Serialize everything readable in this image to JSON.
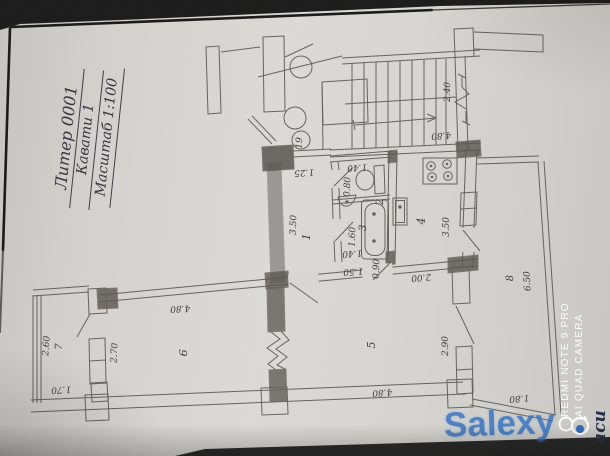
{
  "title_block": {
    "line1": "Литер 0001",
    "line2": "Кавати 1",
    "line3": "Масштаб 1:100"
  },
  "plan": {
    "entrance_circle_label": "19",
    "labels": [
      {
        "t": "1",
        "x": 310,
        "y": 237,
        "r": -88,
        "s": 11
      },
      {
        "t": "2",
        "x": 383,
        "y": 202,
        "r": -88,
        "s": 10
      },
      {
        "t": "3",
        "x": 366,
        "y": 228,
        "r": -88,
        "s": 10
      },
      {
        "t": "4",
        "x": 425,
        "y": 221,
        "r": -90,
        "s": 11
      },
      {
        "t": "5",
        "x": 375,
        "y": 345,
        "r": -90,
        "s": 11
      },
      {
        "t": "6",
        "x": 187,
        "y": 353,
        "r": -87,
        "s": 11
      },
      {
        "t": "7",
        "x": 62,
        "y": 347,
        "r": -86,
        "s": 10
      },
      {
        "t": "8",
        "x": 513,
        "y": 278,
        "r": -93,
        "s": 10
      },
      {
        "t": "19",
        "x": 302,
        "y": 143,
        "r": -88,
        "s": 9
      },
      {
        "t": "3.50",
        "x": 296,
        "y": 225,
        "r": -88,
        "s": 9
      },
      {
        "t": "1.25",
        "x": 304,
        "y": 170,
        "r": 176,
        "s": 9
      },
      {
        "t": "1.40",
        "x": 357,
        "y": 165,
        "r": 176,
        "s": 9
      },
      {
        "t": "0.80",
        "x": 350,
        "y": 187,
        "r": -88,
        "s": 9
      },
      {
        "t": "1.60",
        "x": 355,
        "y": 237,
        "r": -88,
        "s": 9
      },
      {
        "t": "1.40",
        "x": 352,
        "y": 251,
        "r": 176,
        "s": 9
      },
      {
        "t": "1.50",
        "x": 353,
        "y": 269,
        "r": 176,
        "s": 9
      },
      {
        "t": "0.90",
        "x": 379,
        "y": 269,
        "r": -88,
        "s": 9
      },
      {
        "t": "2.00",
        "x": 421,
        "y": 275,
        "r": 176,
        "s": 9
      },
      {
        "t": "3.50",
        "x": 449,
        "y": 227,
        "r": -90,
        "s": 9
      },
      {
        "t": "2.40",
        "x": 450,
        "y": 92,
        "r": -89,
        "s": 9
      },
      {
        "t": "4.80",
        "x": 441,
        "y": 133,
        "r": 176,
        "s": 9
      },
      {
        "t": "4.80",
        "x": 180,
        "y": 306,
        "r": 177,
        "s": 9
      },
      {
        "t": "2.70",
        "x": 117,
        "y": 353,
        "r": -87,
        "s": 9
      },
      {
        "t": "2.60",
        "x": 49,
        "y": 346,
        "r": -86,
        "s": 9
      },
      {
        "t": "1.70",
        "x": 61,
        "y": 387,
        "r": 177,
        "s": 9
      },
      {
        "t": "4.80",
        "x": 382,
        "y": 390,
        "r": 176,
        "s": 9
      },
      {
        "t": "2.90",
        "x": 448,
        "y": 346,
        "r": -91,
        "s": 9
      },
      {
        "t": "6.50",
        "x": 530,
        "y": 281,
        "r": -93,
        "s": 9
      },
      {
        "t": "1.80",
        "x": 519,
        "y": 396,
        "r": 176,
        "s": 9
      }
    ]
  },
  "watermarks": {
    "brand": "Salexy",
    "camera_line1": "REDMI NOTE 9 PRO",
    "camera_line2": "AI QUAD CAMERA",
    "corner_text": "аси"
  },
  "colors": {
    "paper": "#d6d5d1",
    "ink": "#55504a",
    "brand_blue": "#2c6ab9",
    "watermark_white": "#ffffff"
  }
}
